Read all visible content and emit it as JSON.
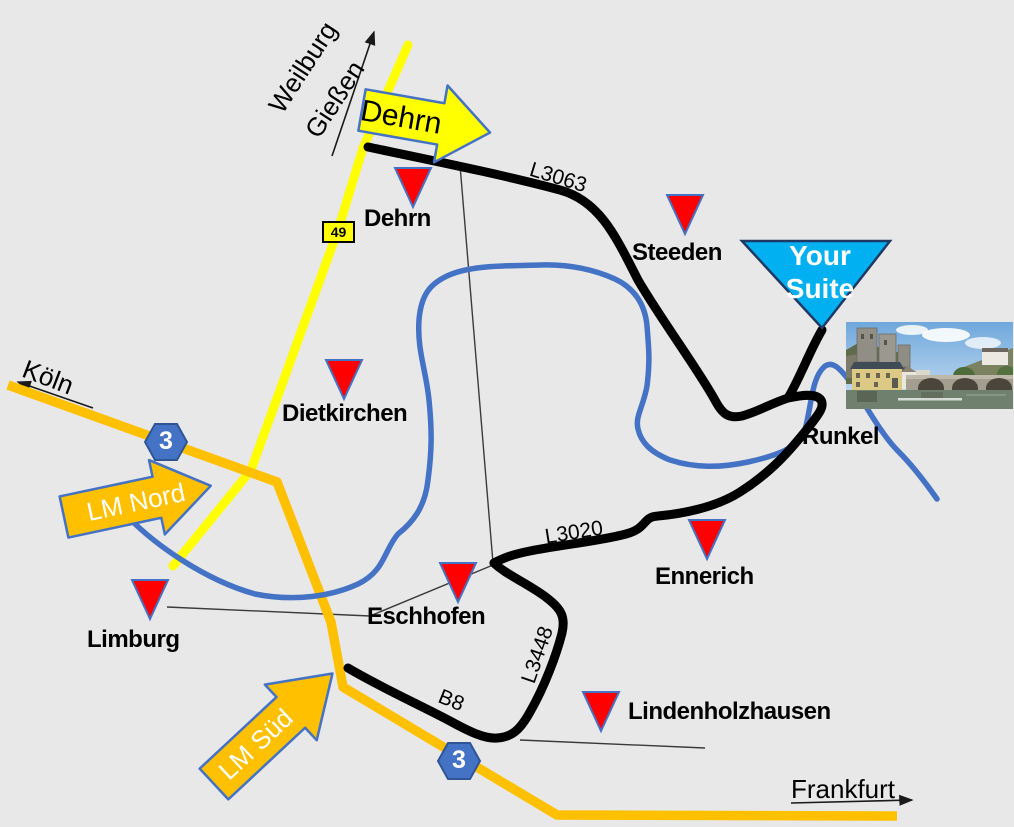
{
  "map": {
    "background_color": "#E8E8E8",
    "towns": [
      {
        "name": "Dehrn"
      },
      {
        "name": "Steeden"
      },
      {
        "name": "Dietkirchen"
      },
      {
        "name": "Limburg"
      },
      {
        "name": "Eschhofen"
      },
      {
        "name": "Ennerich"
      },
      {
        "name": "Lindenholzhausen"
      },
      {
        "name": "Runkel"
      }
    ],
    "destination": {
      "line1": "Your",
      "line2": "Suite"
    },
    "signs": {
      "koeln": "Köln",
      "frankfurt": "Frankfurt",
      "weilburg": "Weilburg",
      "giessen": "Gießen"
    },
    "arrows": {
      "dehrn": "Dehrn",
      "lm_nord": "LM Nord",
      "lm_sued": "LM Süd"
    },
    "roads": {
      "l3063": "L3063",
      "l3020": "L3020",
      "l3448": "L3448",
      "b8": "B8",
      "b49_badge": "49",
      "a3_badge": "3"
    },
    "colors": {
      "river": "#4472C4",
      "road_primary": "#000000",
      "road_b49": "#FFFF00",
      "road_a3": "#FFC000",
      "town_marker": "#FF0000",
      "destination_fill": "#00B0F0",
      "autobahn_badge": "#4472C4"
    },
    "photo": {
      "label": "runkel-castle-and-lahn-bridge-photo"
    }
  }
}
